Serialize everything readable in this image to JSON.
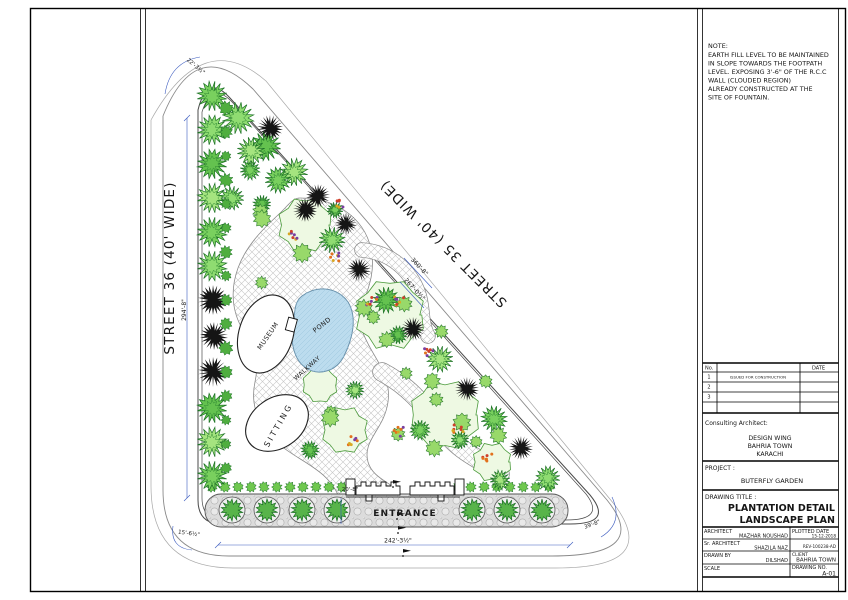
{
  "note": {
    "title": "NOTE:",
    "lines": [
      "EARTH FILL LEVEL TO BE MAINTAINED",
      "IN SLOPE TOWARDS THE FOOTPATH",
      "LEVEL. EXPOSING 3'-6\" OF THE R.C.C",
      "WALL (CLOUDED REGION)",
      " ALREADY CONSTRUCTED AT THE",
      "SITE OF FOUNTAIN."
    ]
  },
  "plan": {
    "street_left": "STREET 36 (40' WIDE)",
    "street_right": "STREET 35 (40' WIDE)",
    "museum": "MUSEUM",
    "pond": "POND",
    "sitting": "SITTING",
    "walkway": "WALKWAY",
    "entrance": "ENTRANCE",
    "dim": {
      "top": "22'-3½\"",
      "left": "294'-8\"",
      "hyp_a": "360'-8\"",
      "hyp_b": "267'-0½\"",
      "bottom": "242'-3½\"",
      "bottom_left": "15'-6½\"",
      "bottom_right": "39'-8\"",
      "entrance_w": "20'-8\""
    },
    "colors": {
      "dimension": "#3b5bbf",
      "pond_fill": "#bcdcee",
      "tree_green": "#64c24f",
      "tree_dark": "#151515"
    }
  },
  "tb": {
    "rev": {
      "no_h": "No.",
      "date_h": "DATE",
      "rows": [
        {
          "no": "1",
          "desc": "ISSUED FOR CONSTRUCTION",
          "date": ""
        },
        {
          "no": "2",
          "desc": "",
          "date": ""
        },
        {
          "no": "3",
          "desc": "",
          "date": ""
        }
      ]
    },
    "consulting_label": "Consulting Architect:",
    "consulting": [
      "DESIGN WING",
      "BAHRIA TOWN",
      "KARACHI"
    ],
    "project_label": "PROJECT :",
    "project": "BUTERFLY GARDEN",
    "title_label": "DRAWING TITLE :",
    "title1": "PLANTATION DETAIL",
    "title2": "LANDSCAPE PLAN",
    "architect_label": "ARCHITECT",
    "architect": "MAZHAR NOUSHAD",
    "plotted_label": "PLOTTED DATE",
    "plotted": "15-12-2018",
    "sr_label": "Sr. ARCHITECT",
    "sr": "SHAZILA NAZ",
    "file_no": "REV-100238-AD",
    "drawn_label": "DRAWN BY",
    "drawn": "DILSHAD",
    "client_label": "CLIENT",
    "client": "BAHRIA TOWN",
    "scale_label": "SCALE",
    "dwg_label": "DRAWING NO.",
    "dwg": "A-01"
  }
}
